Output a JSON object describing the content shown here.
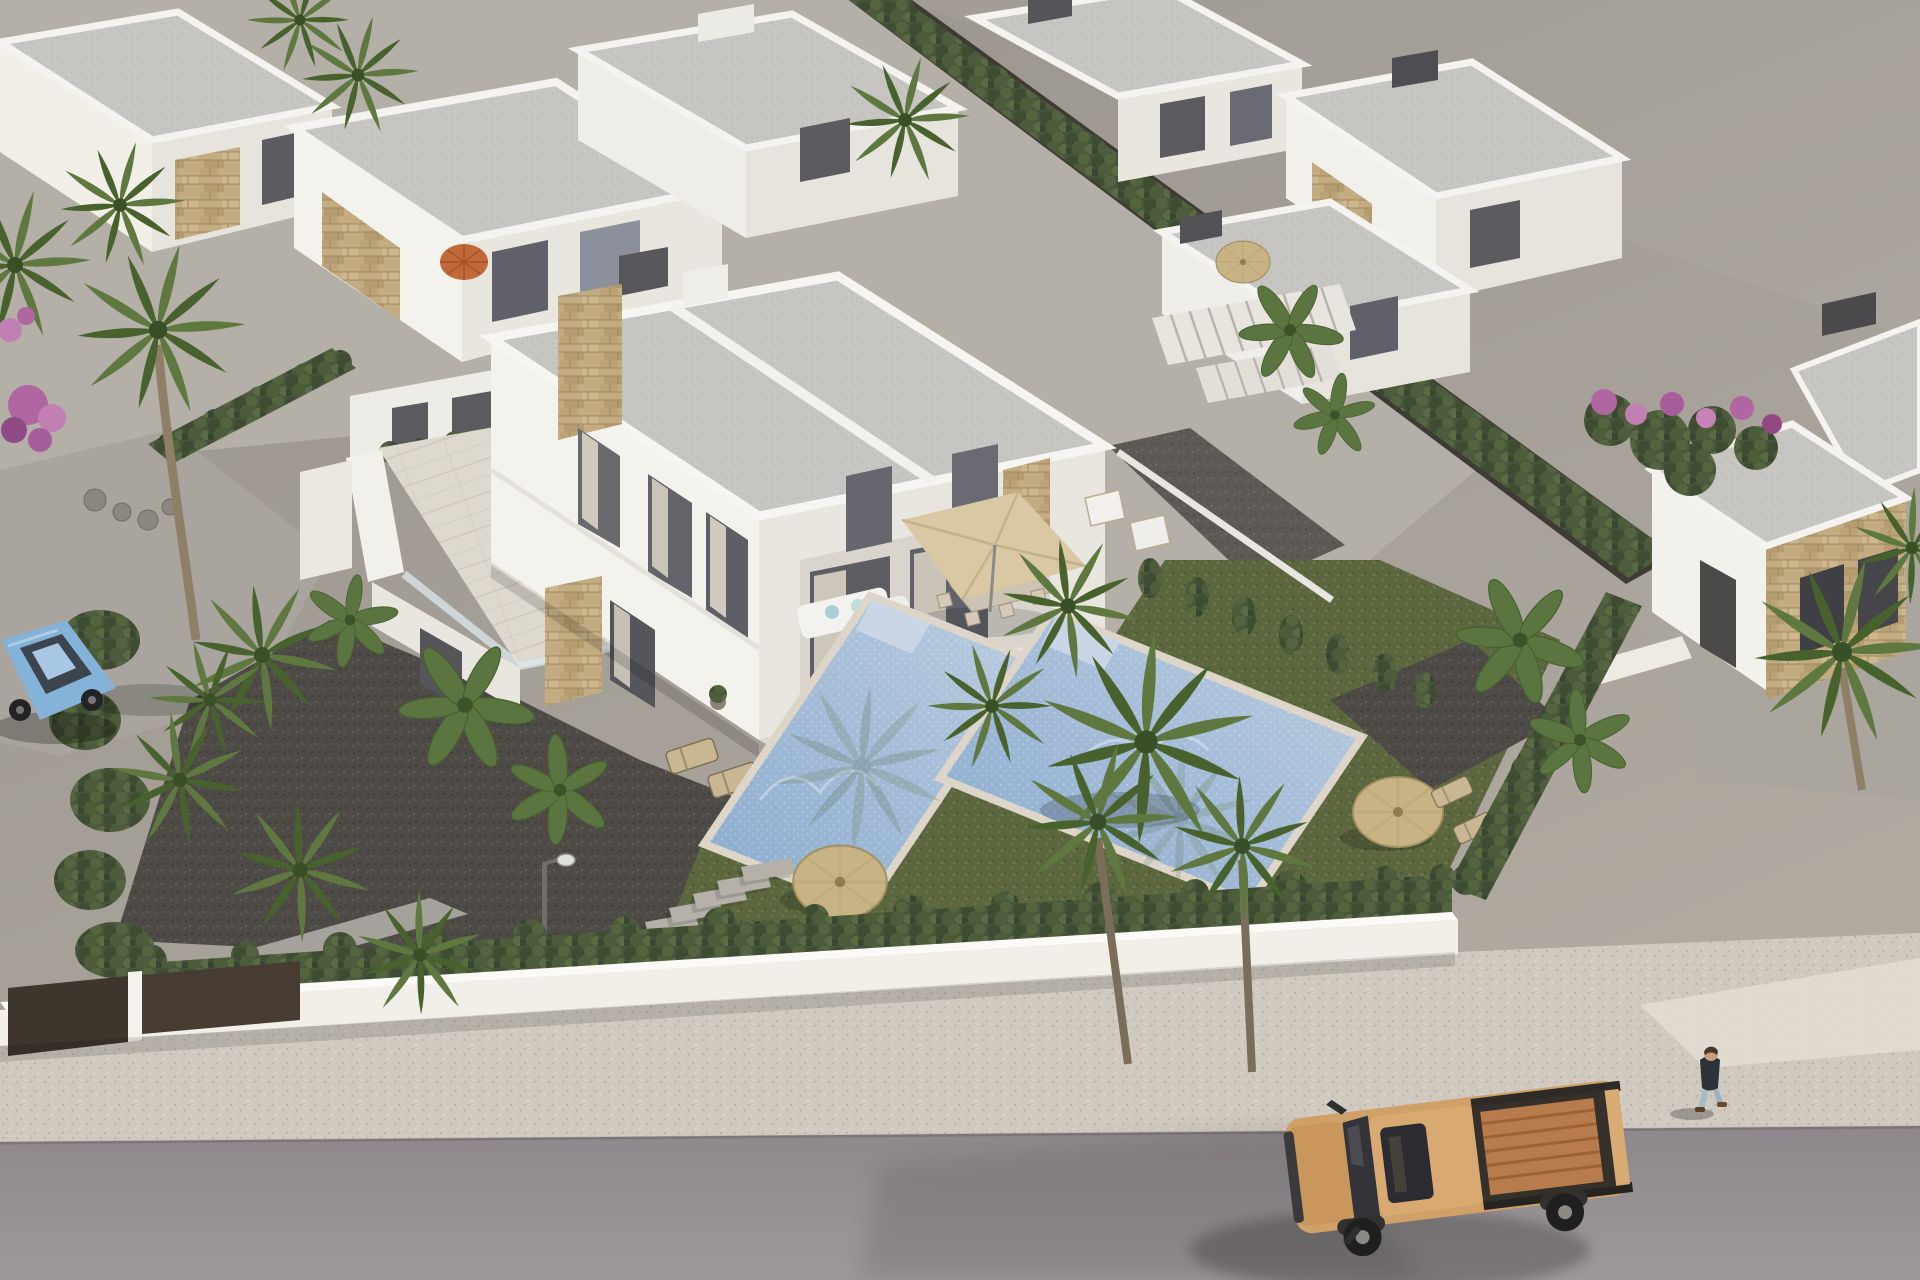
{
  "meta": {
    "type": "aerial-3d-architectural-render",
    "description": "Aerial 3D render of a modern white villa development: a central two-storey duplex villa with two private pools, gardens with palm trees and straw parasols, surrounding white flat-roof villas with stone cladding, a white perimeter wall with hedges, a sidewalk and road with an orange pickup truck, a parked light-blue car and a pedestrian."
  },
  "palette": {
    "ground_top": "#97928b",
    "ground_bottom": "#b1aba2",
    "road_dark": "#8e888c",
    "road_light": "#9d989a",
    "sidewalk": "#cfc9bf",
    "wall_white": "#f2efe9",
    "gate_brown": "#3e352c",
    "hedge": "#47553a",
    "grass": "#5c673f",
    "gravel_dark": "#4e4b47",
    "gravel_light": "#8e8a83",
    "roof": "#c7c5c1",
    "facade_sunlit": "#f4f2ec",
    "facade_shade": "#e9e6e0",
    "stone": "#c3ab82",
    "terrace_tile": "#ded9cf",
    "pool_deep": "#8aabce",
    "pool_light": "#bccde0",
    "pool_steps": "#c9d6e5",
    "straw": "#c8b384",
    "parasol_beige": "#d9c8a3",
    "umbrella_orange": "#c2693a",
    "truck_body": "#cfa068",
    "truck_bed": "#b87c4c",
    "car_body": "#85b2d8",
    "person_jacket": "#2d3138",
    "person_jeans": "#a6bac9",
    "palm_light": "#5e7840",
    "palm_dark": "#48622e",
    "trunk": "#8f7f67",
    "bougainvillea": "#b066a0"
  },
  "inventory": {
    "hero_building": "two-storey duplex villa, white render with natural stone cladding",
    "pools": 2,
    "background_villas": 7,
    "straw_parasols": 3,
    "square_parasols": 1,
    "orange_umbrellas": 1,
    "sun_loungers": 6,
    "vehicles": [
      "orange pickup truck on road",
      "light blue car parked left"
    ],
    "people": 1,
    "landscaping": [
      "palm trees",
      "banana plants",
      "cypress hedges",
      "bougainvillea",
      "lawn",
      "dark gravel yard",
      "stepping stones",
      "street lamp"
    ]
  }
}
